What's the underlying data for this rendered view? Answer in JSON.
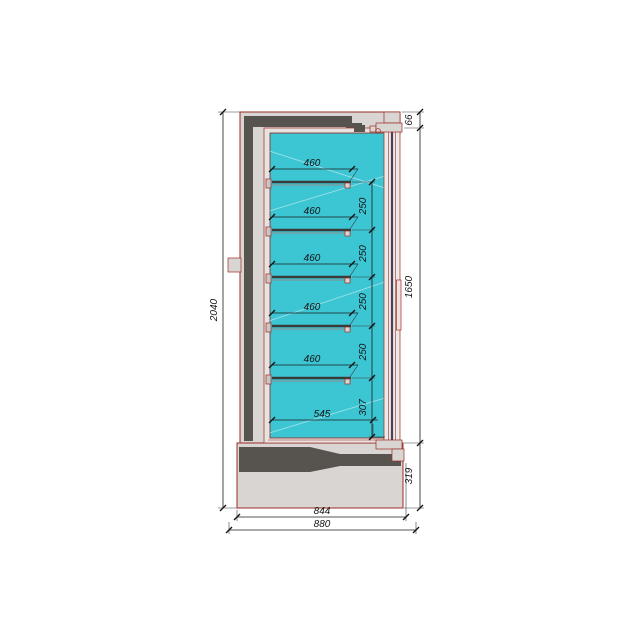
{
  "drawing": {
    "kind": "refrigerated-cabinet-cross-section",
    "dimensions": {
      "overall_height": "2040",
      "canopy_height": "66",
      "shelf_depths": [
        "460",
        "460",
        "460",
        "460",
        "460"
      ],
      "shelf_spacings": [
        "250",
        "250",
        "250",
        "250"
      ],
      "bottom_spacing": "307",
      "door_opening_height": "1650",
      "base_height": "319",
      "bottom_shelf_depth": "545",
      "base_depth": "844",
      "overall_depth": "880"
    },
    "colors": {
      "interior_fill": "#3cc5d3",
      "casing_fill": "#d8d5d2",
      "liner_fill": "#e6e3e0",
      "door_fill": "#ece9e7",
      "insulation_fill": "#57544f",
      "outline_stroke": "#9e2b25",
      "glass_stroke": "#484358",
      "dimension_stroke": "#1c1c1c",
      "background": "#ffffff"
    }
  }
}
